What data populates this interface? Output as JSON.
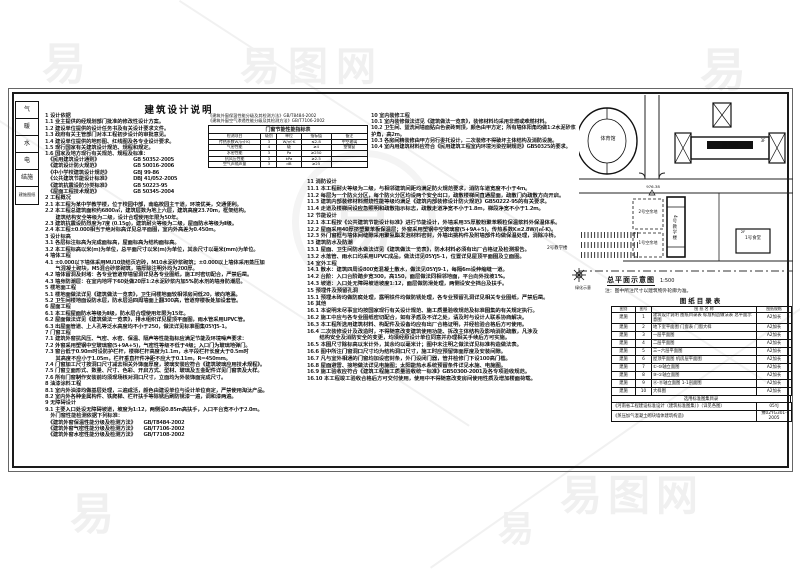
{
  "watermark": {
    "logo": "易",
    "site_name": "易图网"
  },
  "sheet": {
    "title": "建筑设计说明"
  },
  "sign_strip": {
    "cells": [
      "气",
      "暖",
      "水",
      "电",
      "结施",
      "建施图纸"
    ]
  },
  "notes": {
    "col1_top": [
      "1 设计依据",
      "1.1 业主提供的经规划部门批准的修改性设计方案。",
      "1.2 建设单位提供的设计任务书及有关设计要求文件。",
      "1.3 政府有关主管部门对本工程初步设计的审批意见。",
      "1.4 建设单位提供的地形图、红线图及各专业设计要求。",
      "1.5 现行国家有关建筑设计规范、规程和规定。",
      "1.6 国家及地方现行有关规范、规程及标准："
    ],
    "col1_main": [
      "　《民用建筑设计通则》　　　　　　　GB 50352-2005",
      "　《建筑设计防火规范》　　　　　　　GB 50016-2006",
      "　《中小学校建筑设计规范》　　　　　GBJ 99-86",
      "　《公共建筑节能设计标准》　　　　　DBJ 41/052-2005",
      "　《建筑抗震设防分类标准》　　　　　GB 50223-95",
      "　《屋面工程技术规范》　　　　　　　GB 50345-2004",
      "2 工程概况",
      "2.1 本工程为某中学教学楼，位于校园中部，南临校园主干道，环境优美，交通便利。",
      "2.2 本工程总建筑面积约6800㎡，建筑层数为地上六层，建筑高度23.70m，框架结构。",
      "　　建筑结构安全等级为二级，设计合理使用年限为50年。",
      "2.3 建筑抗震设防烈度为7度 (0.15g)，建筑耐火等级为二级，屋面防水等级为Ⅱ级。",
      "2.4 本工程±0.000相当于绝对标高详见总平面图，室内外高差为0.450m。",
      "3 设计标高",
      "3.1 各层标注标高为完成面标高，屋面标高为结构面标高。",
      "3.2 本工程标高以米(m)为单位，总平面尺寸以米(m)为单位，其余尺寸以毫米(mm)为单位。",
      "4 墙体工程",
      "4.1 ±0.000以下墙体采用MU10烧结页岩砖，M10水泥砂浆砌筑；±0.000以上墙体采用蒸压加",
      "　　气混凝土砌块，M5混合砂浆砌筑，墙厚除注明外均为200厚。",
      "4.2 墙体留洞及封堵：各专业管道穿墙留洞详见各专业图纸，施工时密切配合，严禁后凿。",
      "4.3 墙身防潮层：在室内地坪下60处做20厚1:2水泥砂浆内加5%防水剂的墙身防潮层。",
      "5 楼地面工程",
      "5.1 楼地面做法详见《建筑做法一览表》，卫生间楼地面较相邻房间低20，坡向地漏。",
      "5.2 卫生间楼地面设防水层，防水层沿四周墙面上翻300高，管道穿楼板处加设套管。",
      "6 屋面工程",
      "6.1 本工程屋面防水等级为Ⅱ级，防水层合理使用年限为15年。",
      "6.2 屋面做法详见《建筑做法一览表》，排水组织详见屋顶平面图，雨水管采用UPVC管。",
      "6.3 出屋面管道、上人孔等泛水高度均不小于250，做法详见标准图集05YJ5-1。",
      "7 门窗工程",
      "7.1 建筑外窗抗风压、气密、水密、保温、隔声等性能指标应满足节能及环境噪声要求：",
      "7.2 外窗采用塑钢中空玻璃窗(5+9A+5)，气密性等级不低于4级；入口门为玻璃地弹门。",
      "7.3 窗台低于0.90m时设防护栏杆，楼梯栏杆高度为1.1m，水平段栏杆长度大于0.5m时",
      "　　其高度不应小于1.05m，栏杆垂直杆件净距不应大于0.11m，R=450mm。",
      "7.4 门窗加工尺寸按洞口尺寸减去相关外饰面厚度，玻璃安装应符合《建筑玻璃应用技术规程》。",
      "7.5 门窗立面形式、数量、尺寸、色彩、开启方式、型材、玻璃及五金配件详见门窗表及大样。",
      "7.6 所有门窗制作安装前均须现场核对洞口尺寸，立面均为外装饰面完成尺寸。",
      "8 油漆涂料工程",
      "8.1 室内外油漆均做基层处理，三遍成活，颜色由建设单位与设计单位商定，严禁使用淘汰产品。",
      "8.2 室内外各种金属构件、铁爬梯、栏杆扶手等除锈后刷防锈漆一遍，调和漆两遍。",
      "9 无障碍设计",
      "9.1 主要入口处设无障碍坡道，坡度为1:12，两侧设0.85m高扶手，入口平台宽不小于2.0m。",
      "　外门窗性能检测依据下列标准：",
      "　《建筑外窗保温性能分级及检测方法》　　GB/T8484-2002",
      "　《建筑外窗气密性能分级及检测方法》　　GB/T7106-2002",
      "　《建筑外窗水密性能分级及检测方法》　　GB/T7108-2002"
    ],
    "col_mid_top": [
      "10 室内装修工程",
      "10.1 室内装修做法详见《建筑做法一览表》，装修材料均采用非燃或难燃材料。",
      "10.2 卫生间、盥洗间墙面贴白色瓷砖到顶，颜色由甲方定；所有墙体阳角均做1:2水泥砂浆护角，高2m。",
      "10.3 各房间精装修由甲方另行委托设计，二次装修不得破坏主体结构及消防设施。",
      "10.4 室内用建筑材料应符合《民用建筑工程室内环境污染控制规范》GB50325的要求。"
    ],
    "col2_main": [
      "11 消防设计",
      "11.1 本工程耐火等级为二级，与相邻建筑间距均满足防火规范要求，消防车道宽度不小于4m。",
      "11.2 每层为一个防火分区，每个防火分区均设两个安全出口，疏散楼梯间直通屋面，疏散门向疏散方向开启。",
      "11.3 建筑内部装修材料燃烧性能等级均满足《建筑内部装修设计防火规范》GB50222-95的有关要求。",
      "11.4 走道及楼梯间设应急照明和疏散指示标志，疏散走道净宽不小于1.8m，梯段净宽不小于1.2m。",
      "12 节能设计",
      "12.1 本工程按《公共建筑节能设计标准》进行节能设计，外墙采用35厚胶粉聚苯颗粒保温浆料外保温体系。",
      "12.2 屋面采用40厚挤塑聚苯板保温层；外窗采用塑钢中空玻璃窗(5+9A+5)，传热系数K≤2.8W/(㎡·K)。",
      "12.3 外门窗框与墙体间缝隙采用聚氨酯发泡材料密封，外墙出挑构件及附墙部件均做保温处理，消除冷桥。",
      "13 建筑防水及防潮",
      "13.1 屋面、卫生间防水做法详见《建筑做法一览表》，防水材料必须有出厂合格证及检测报告。",
      "13.2 水落管、雨水口均采用UPVC成品，做法详见05YJ5-1，位置详见屋顶平面图及立面图。",
      "14 室外工程",
      "14.1 散水：建筑四周设800宽混凝土散水，做法见05YJ9-1，每隔6m设伸缩缝一道。",
      "14.2 台阶：入口台阶踏步宽300，高150，面层做法同相邻地面，平台向外找坡1%。",
      "14.3 坡道：入口处无障碍坡道坡度1:12，面层做防滑处理，两侧设安全挡台及扶手。",
      "15 预埋件及预留孔洞",
      "15.1 预埋木砖均做防腐处理，露明铁件均做防锈处理，各专业预留孔洞详见相关专业图纸，严禁后凿。",
      "16 其他",
      "16.1 本说明未尽事宜均按国家现行有关设计规范、施工质量验收规范及标准图集的有关规定执行。",
      "16.2 施工中应与各专业图纸密切配合，如有矛盾及不详之处，请及时与设计人联系协商解决。",
      "16.3 本工程所选用建筑材料、构配件及设备均应有出厂合格证明，并经检验合格后方可使用。",
      "16.4 二次装修设计及改造时，不得随意改变建筑使用功能、拆改主体结构及影响消防疏散，凡涉及",
      "　　 结构安全及消防安全的变更，均须经原设计单位同意并办理相关手续后方可实施。",
      "16.5 本图尺寸除标高以米计外，其余均以毫米计；图中未注明之做法详见标准构造做法表。",
      "16.6 图中所注门窗洞口尺寸均为结构洞口尺寸，施工时应预留饰面厚度及安装间隙。",
      "16.7 凡与室外相通的门窗均加设密封条，外门设闭门器，管井检修门下设100高门槛。",
      "16.8 屋面避雷、接地做法详见电施图；太阳能热水系统预留条件详见水施、电施图。",
      "16.9 施工验收应符合《建筑工程施工质量验收统一标准》GB50300-2001及各专项验收规范。",
      "16.10 本工程竣工验收合格后方可交付使用，使用中不得随意改变房间使用性质及增加楼面荷载。"
    ]
  },
  "window_table": {
    "refs": [
      "《建筑外窗保温性能分级及其检测方法》GB/T8484-2002",
      "《建筑外窗空气渗透性能分级及其检测方法》GB/T7106-2002"
    ],
    "title": "门窗节能性能指标表",
    "columns": [
      "检测项目",
      "级别",
      "单位",
      "指标值",
      "备注"
    ],
    "rows": [
      [
        "传热系数W/(㎡·K)",
        "3",
        "W/㎡·K",
        "≤2.8",
        "中空玻璃"
      ],
      [
        "气密性能",
        "4",
        "级",
        "≥4",
        "塑钢窗"
      ],
      [
        "水密性能",
        "3",
        "Pa",
        "≥250",
        ""
      ],
      [
        "抗风压性能",
        "3",
        "kPa",
        "≥2.5",
        ""
      ],
      [
        "空气声隔声量",
        "3",
        "dB",
        "≥25",
        ""
      ]
    ]
  },
  "site_plan": {
    "labels": {
      "gym": "体育馆",
      "library": "图书馆",
      "library_storey": "3F",
      "lot2": "2号空余地",
      "lot1": "1号空余地",
      "main_building": "4号教学楼",
      "canteen": "1号食堂",
      "canteen_storey": "2F",
      "school2": "2号教学楼",
      "elevation": "976.38",
      "green": "绿化示意"
    },
    "caption": "总平面示意图",
    "scale": "1:500",
    "note": "注：图中所注尺寸以建筑物外轮廓为准。"
  },
  "drawing_index": {
    "title": "图纸目录表",
    "columns": [
      "图别",
      "图号",
      "图 纸 名 称",
      "图纸规格"
    ],
    "rows": [
      [
        "建施",
        "1",
        "建筑设计说明 图纸目录表 标准构造做法表 总平面示意图",
        "A2加长"
      ],
      [
        "建施",
        "2",
        "地下室平面图 门窗表 门窗大样",
        "A2加长"
      ],
      [
        "建施",
        "3",
        "一层平面图",
        "A2加长"
      ],
      [
        "建施",
        "4",
        "二层平面图",
        "A2加长"
      ],
      [
        "建施",
        "5",
        "三~六层平面图",
        "A2加长"
      ],
      [
        "建施",
        "6",
        "屋顶平面图 机房层平面图",
        "A2加长"
      ],
      [
        "建施",
        "7",
        "①-⑩轴立面图",
        "A2加长"
      ],
      [
        "建施",
        "8",
        "⑩-①轴立面图",
        "A2加长"
      ],
      [
        "建施",
        "9",
        "Ⓐ-Ⓓ轴立面图 1-1剖面图",
        "A2加长"
      ],
      [
        "建施",
        "10",
        "大样图",
        "A2加长"
      ]
    ],
    "atlas_header": "选用标准图集目录",
    "atlas_rows": [
      [
        "《河南省工程建设标准设计（建筑标准图集）》（详见各图）",
        "05YJ"
      ],
      [
        "《蒸压加气混凝土砌块墙体建筑构造》",
        "豫02YG301-2005"
      ]
    ]
  }
}
